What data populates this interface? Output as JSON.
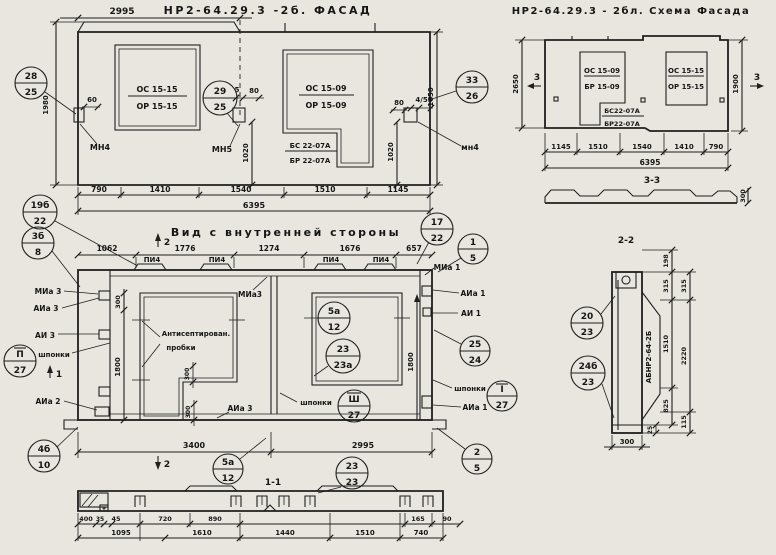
{
  "sheet": {
    "bg": "#e8e6df",
    "ink": "#1f1f1f"
  },
  "titles": {
    "facade": "НР2-64.29.3 -2б. ФАСАД",
    "schema": "НР2-64.29.3 - 2бл. Схема Фасада",
    "inner": "Вид с внутренней стороны",
    "s11": "1-1",
    "s22": "2-2",
    "s33": "3-3"
  },
  "facade": {
    "dim_top": "2995",
    "dim_h_left": "1980",
    "dim_h_right": "1650",
    "dims_bottom": [
      "790",
      "1410",
      "1540",
      "1510",
      "1145"
    ],
    "dim_total": "6395",
    "d60": "60",
    "d5": "5",
    "d80": "80",
    "d80r": "80",
    "d455": "4/55",
    "d1020a": "1020",
    "d1020b": "1020",
    "win1_top": "ОС 15-15",
    "win1_bot": "ОР 15-15",
    "win2_top": "ОС 15-09",
    "win2_bot": "ОР 15-09",
    "block_top": "БС 22-07А",
    "block_bot": "БР 22-07А",
    "mn_left": "МН4",
    "mn_mid": "МН5",
    "mn_right": "мн4"
  },
  "schema": {
    "dim_h_left": "2650",
    "dim_h_right": "1900",
    "mark_left": "3",
    "mark_right": "3",
    "win1_top": "ОС 15-09",
    "win1_bot": "БР 15-09",
    "win2_top": "ОС 15-15",
    "win2_bot": "ОР 15-15",
    "block_top": "БС22-07А",
    "block_bot": "БР22-07А",
    "dims_bottom": [
      "1145",
      "1510",
      "1540",
      "1410",
      "790"
    ],
    "dim_total": "6395",
    "profile_h": "300"
  },
  "inner": {
    "dims_top": [
      "1062",
      "1776",
      "1274",
      "1676",
      "657"
    ],
    "dims_bottom": [
      "3400",
      "2995"
    ],
    "pi4": "ПИ4",
    "note1": "Антисептирован.",
    "note2": "пробки",
    "d300_top": "300",
    "d300_a": "300",
    "d300_b": "300",
    "d1800_left": "1800",
    "d1800_right": "1800",
    "shponki": "шпонки",
    "lbl_mia3": "МИа 3",
    "lbl_aia3": "АИа 3",
    "lbl_ai3": "АИ 3",
    "lbl_aia2": "АИа 2",
    "lbl_mia3_top": "МИа3",
    "lbl_mia1": "МИа 1",
    "lbl_aia1": "АИа 1",
    "lbl_ai1": "АИ 1",
    "lbl_aia3_r": "АИа 3",
    "lbl_aia1_b": "АИа 1",
    "mark1": "1",
    "mark2": "2"
  },
  "s11": {
    "row1": [
      "400",
      "35",
      "45",
      "720",
      "890",
      "165",
      "90"
    ],
    "row2": [
      "1095",
      "1610",
      "1440",
      "1510",
      "740"
    ]
  },
  "s22": {
    "d_top": "198",
    "d315a": "315",
    "d315b": "315",
    "d1510": "1510",
    "d2220": "2220",
    "d825": "825",
    "d115": "115",
    "d25": "25",
    "d300": "300",
    "mark": "АБНР2-64-2Б"
  },
  "callouts": [
    [
      "28",
      "25"
    ],
    [
      "29",
      "25"
    ],
    [
      "33",
      "26"
    ],
    [
      "19б",
      "22"
    ],
    [
      "3б",
      "8"
    ],
    [
      "17",
      "22"
    ],
    [
      "1",
      "5"
    ],
    [
      "5а",
      "12"
    ],
    [
      "23",
      "23а"
    ],
    [
      "25",
      "24"
    ],
    [
      "I",
      "27"
    ],
    [
      "Ш",
      "27"
    ],
    [
      "П",
      "27"
    ],
    [
      "4б",
      "10"
    ],
    [
      "5а",
      "12"
    ],
    [
      "23",
      "23"
    ],
    [
      "2",
      "5"
    ],
    [
      "20",
      "23"
    ],
    [
      "24б",
      "23"
    ]
  ]
}
